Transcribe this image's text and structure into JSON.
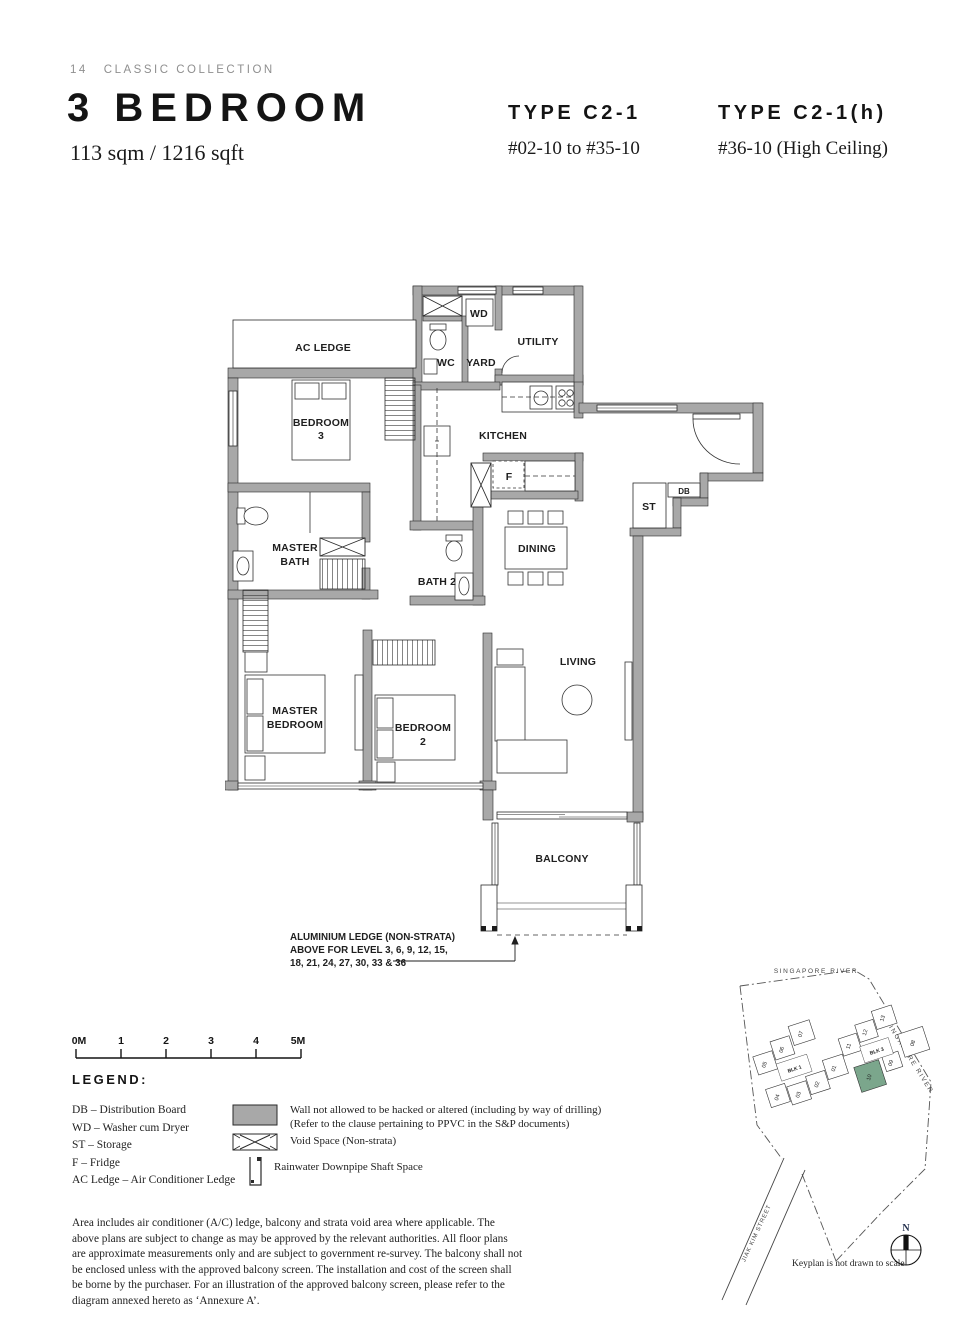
{
  "page": {
    "number": "14",
    "collection": "CLASSIC COLLECTION"
  },
  "header": {
    "title": "3 BEDROOM",
    "area": "113 sqm / 1216 sqft",
    "types": [
      {
        "name": "TYPE C2-1",
        "units": "#02-10 to #35-10"
      },
      {
        "name": "TYPE C2-1(h)",
        "units": "#36-10 (High Ceiling)"
      }
    ]
  },
  "plan": {
    "labels": {
      "ac_ledge": "AC LEDGE",
      "wd": "WD",
      "wc": "WC",
      "yard": "YARD",
      "utility": "UTILITY",
      "kitchen": "KITCHEN",
      "bedroom3": [
        "BEDROOM",
        "3"
      ],
      "master_bath": [
        "MASTER",
        "BATH"
      ],
      "bath2": "BATH 2",
      "fridge": "F",
      "st": "ST",
      "db": "DB",
      "dining": "DINING",
      "living": "LIVING",
      "master_bedroom": [
        "MASTER",
        "BEDROOM"
      ],
      "bedroom2": [
        "BEDROOM",
        "2"
      ],
      "balcony": "BALCONY"
    },
    "annotation": [
      "ALUMINIUM LEDGE (NON-STRATA)",
      "ABOVE FOR LEVEL 3, 6, 9, 12, 15,",
      "18, 21, 24, 27, 30, 33 & 36"
    ]
  },
  "scalebar": {
    "ticks": [
      "0M",
      "1",
      "2",
      "3",
      "4",
      "5M"
    ]
  },
  "legend": {
    "title": "LEGEND:",
    "abbreviations": [
      "DB – Distribution Board",
      "WD – Washer cum Dryer",
      "ST – Storage",
      "F – Fridge",
      "AC Ledge – Air Conditioner Ledge"
    ],
    "symbols": [
      {
        "name": "restricted-wall",
        "lines": [
          "Wall not allowed to be hacked or altered (including by way of drilling)",
          "(Refer to the clause pertaining to PPVC in the S&P documents)"
        ]
      },
      {
        "name": "void-space",
        "lines": [
          "Void Space (Non-strata)"
        ]
      },
      {
        "name": "rainwater-downpipe",
        "lines": [
          "Rainwater Downpipe Shaft Space"
        ]
      }
    ]
  },
  "disclaimer": "Area includes air conditioner (A/C) ledge, balcony and strata void area where applicable. The above plans are subject to change as may be approved by the relevant authorities. All floor plans are approximate measurements only and are subject to government re-survey. The balcony shall not be enclosed unless with the approved balcony screen. The installation and cost of the screen shall be borne by the purchaser. For an illustration of the approved balcony screen, please refer to the diagram annexed hereto as ‘Annexure A’.",
  "keyplan": {
    "river_label": "SINGAPORE RIVER",
    "street_label": "JIAK KIM STREET",
    "caption": "Keyplan is not drawn to scale",
    "compass_north": "N",
    "highlighted_unit": "10",
    "blocks": [
      {
        "name": "BLK 1",
        "units": [
          "05",
          "06",
          "07",
          "01",
          "02",
          "03",
          "04"
        ]
      },
      {
        "name": "BLK 3",
        "units": [
          "11",
          "12",
          "13",
          "08",
          "09",
          "10"
        ]
      }
    ]
  },
  "colors": {
    "wall": "#A8A8A8",
    "highlight_green": "#7BA68C",
    "text": "#1E1E1E",
    "muted": "#8F8F8F"
  }
}
